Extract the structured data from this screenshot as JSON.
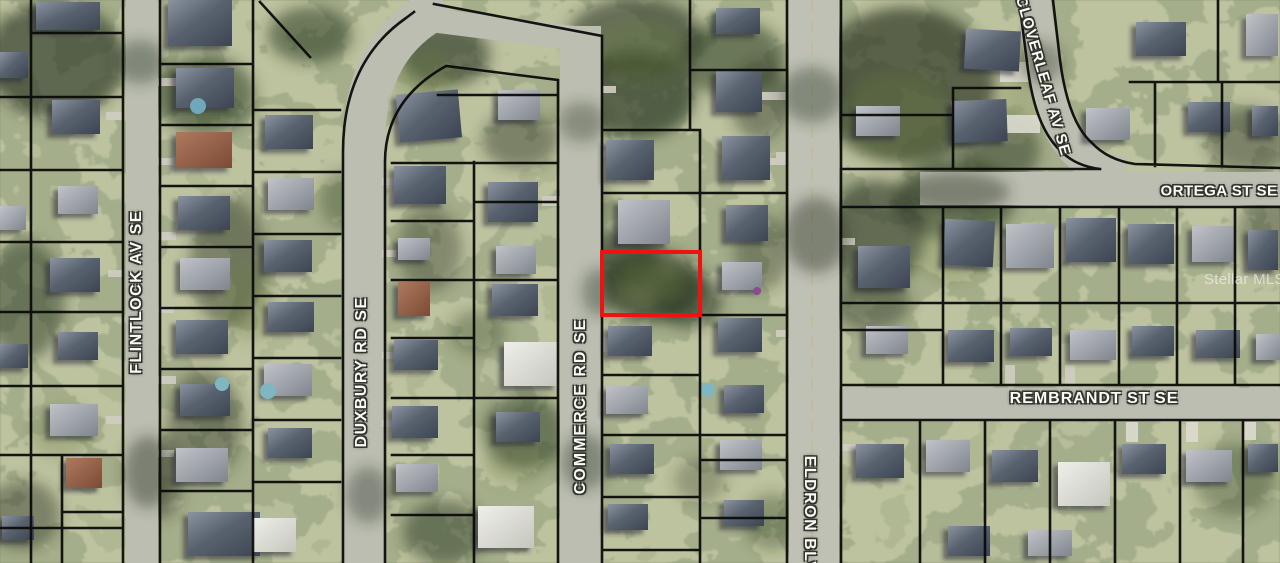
{
  "map": {
    "description": "Aerial parcel map with lot boundary overlay and highlighted subject lot",
    "watermark": "Stellar MLS",
    "highlight_color": "#ee1212",
    "parcel_line_color": "#0b0b0b",
    "streets": [
      {
        "name": "FLINTLOCK AV SE",
        "orientation": "vertical"
      },
      {
        "name": "DUXBURY RD SE",
        "orientation": "vertical"
      },
      {
        "name": "COMMERCE RD SE",
        "orientation": "vertical"
      },
      {
        "name": "ELDRON BLVD",
        "orientation": "vertical"
      },
      {
        "name": "CLOVERLEAF AV SE",
        "orientation": "diagonal"
      },
      {
        "name": "ORTEGA ST SE",
        "orientation": "horizontal"
      },
      {
        "name": "REMBRANDT ST SE",
        "orientation": "horizontal"
      }
    ]
  }
}
